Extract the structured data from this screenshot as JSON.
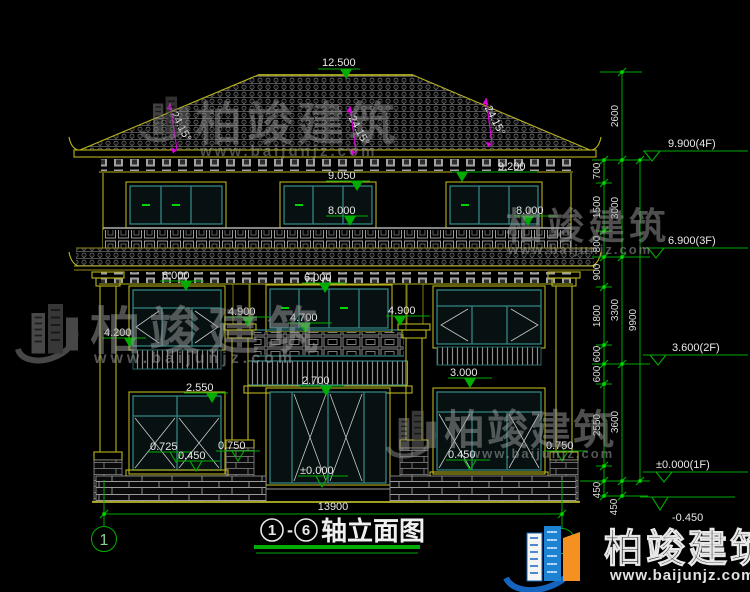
{
  "watermark": {
    "brand": "柏竣建筑",
    "url": "www.baijunjz.com"
  },
  "logo": {
    "brand": "柏竣建筑",
    "url": "www.baijunjz.com"
  },
  "title": {
    "axis_start": "1",
    "separator": "-",
    "axis_end": "6",
    "name": "轴立面图"
  },
  "axis_bubble_left": "1",
  "drawing": {
    "ridge_level": "12.500",
    "roof_slope_left": "24.15°",
    "roof_slope_mid": "24.15°",
    "roof_slope_right": "24.15°",
    "eave_level_left": "9.050",
    "eave_level_right": "9.200",
    "attic_window_left": "8.000",
    "attic_window_right": "8.000",
    "f3_top_left": "6.000",
    "f3_top_right": "6.000",
    "f2_window_left": "4.900",
    "f2_window_right": "4.900",
    "balcony_rail_top": "4.700",
    "side_rail_top": "4.200",
    "spandrel_left": "2.550",
    "balcony_floor": "2.700",
    "spandrel_right": "3.000",
    "sill_left_a": "0.725",
    "sill_left_b": "0.450",
    "pier_left": "0.750",
    "sill_right": "0.450",
    "pier_right": "0.750",
    "entry_level": "±0.000",
    "total_width": "13900"
  },
  "margin": {
    "floors": [
      "9.900(4F)",
      "6.900(3F)",
      "3.600(2F)",
      "±0.000(1F)",
      "-0.450"
    ],
    "chain_inner": [
      "700",
      "1500",
      "800",
      "900",
      "1800",
      "600",
      "600",
      "2550",
      "450"
    ],
    "chain_mid": [
      "2600",
      "3000",
      "3300",
      "3600",
      "450"
    ],
    "chain_outer": [
      "9900"
    ]
  },
  "colors": {
    "background": "#000000",
    "linework_yellow": "#b9b41e",
    "frame_teal": "#348585",
    "dimension_green": "#00ad00",
    "annotation_magenta": "#dd00dd",
    "text_white": "#e9e9e9"
  }
}
